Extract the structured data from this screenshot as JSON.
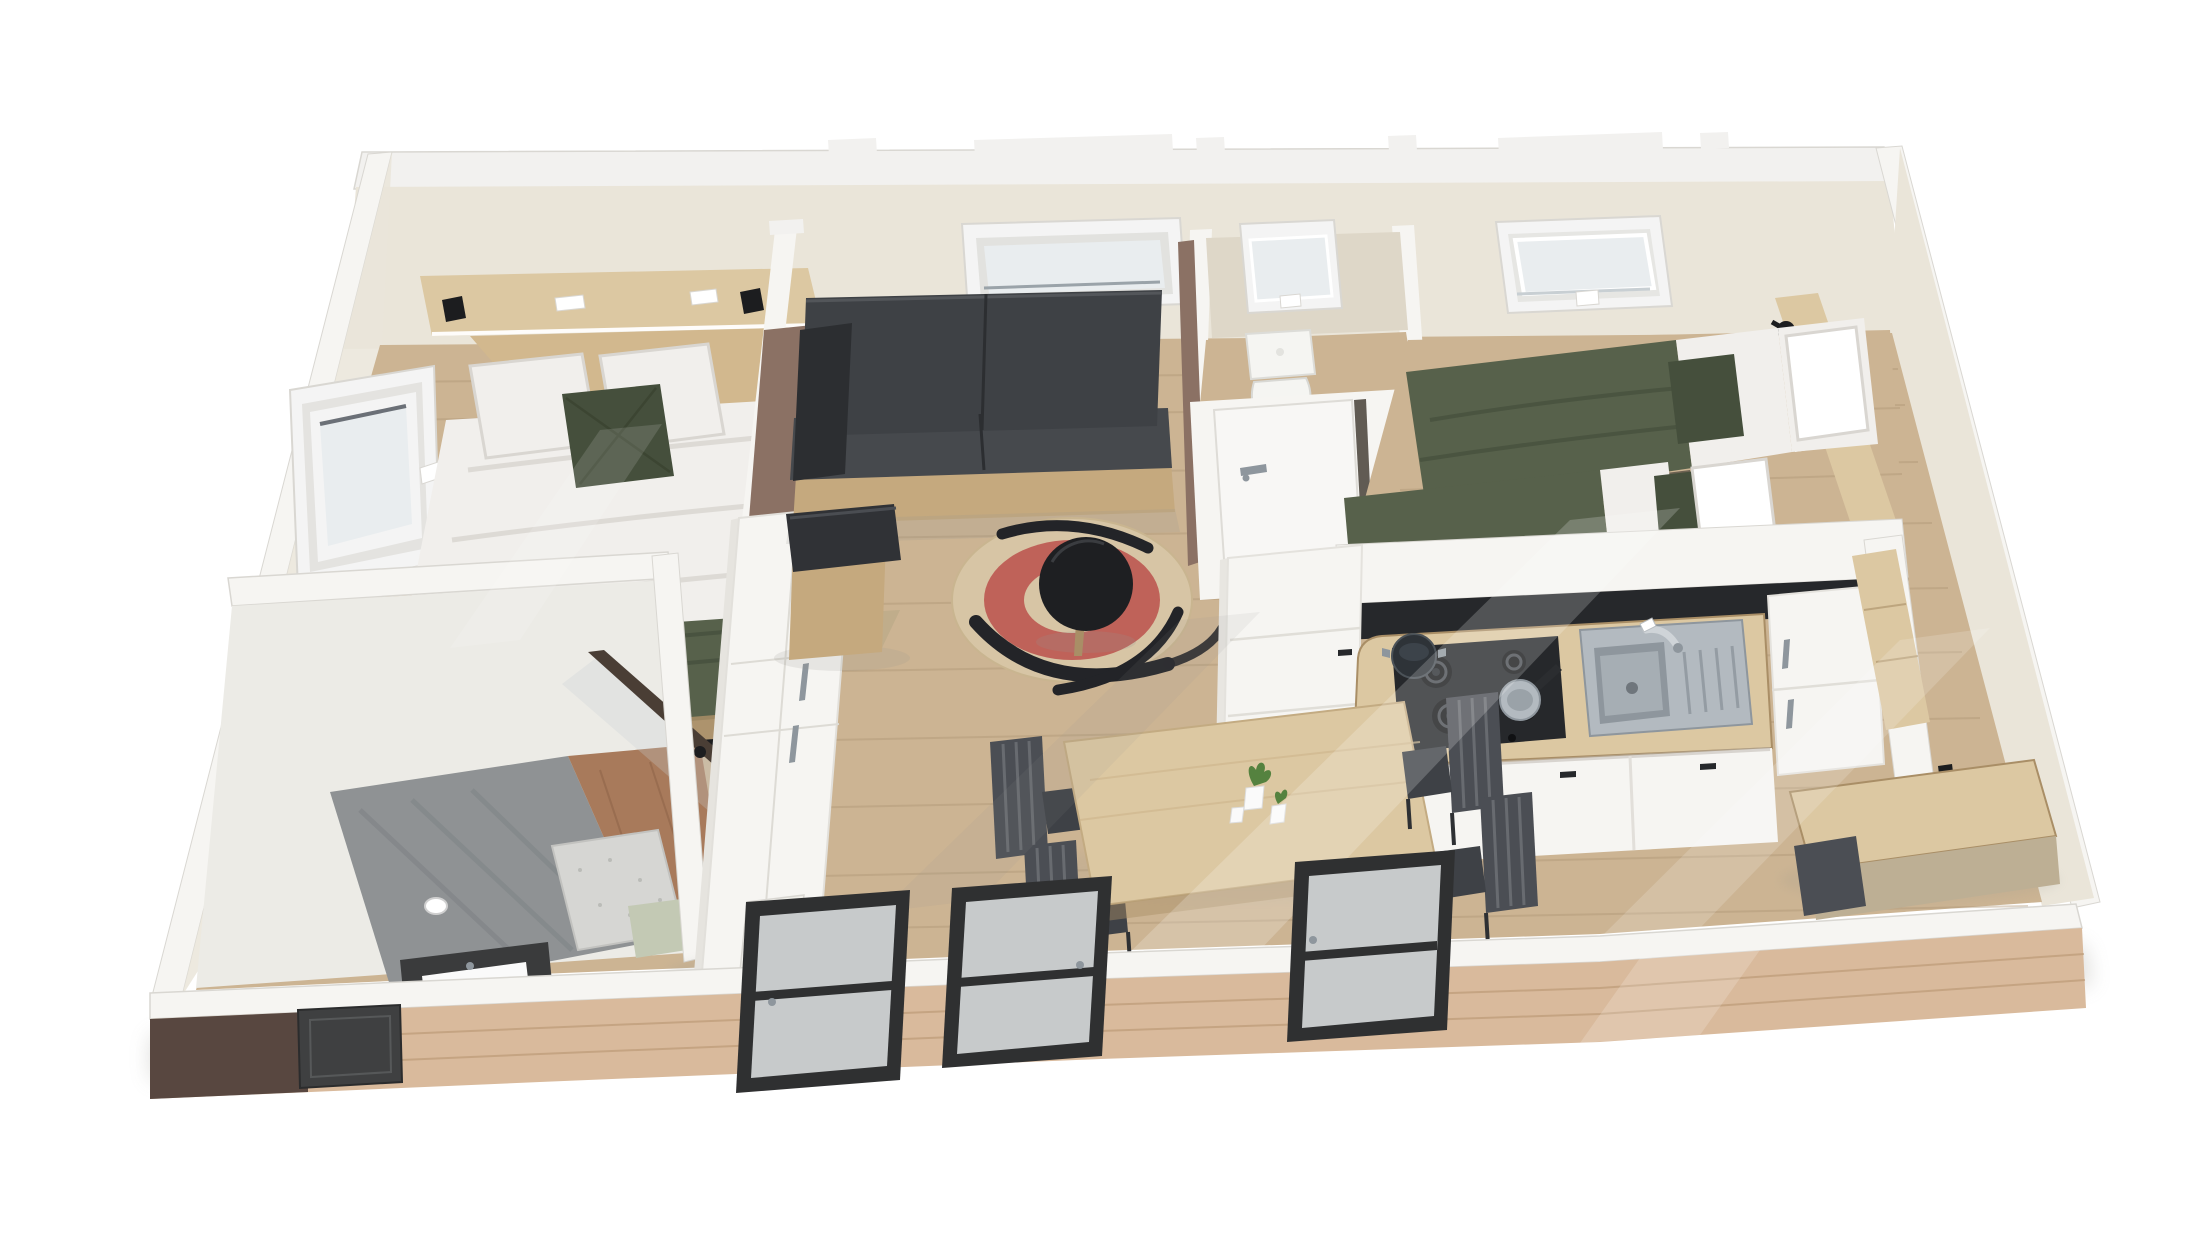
{
  "meta": {
    "title": "3D cutaway floor-plan render of a two-bedroom mobile home, bird's-eye isometric view on a white background",
    "view": "isometric bird's-eye cutaway",
    "background": "plain white"
  },
  "colors": {
    "wall_top": "#f2f1ef",
    "wall_edge": "#d9d7d2",
    "wall_white": "#f6f5f2",
    "wall_face": "#eae5d9",
    "wall_face_shade": "#ded7c8",
    "wall_brown": "#8b7164",
    "floor_wood": "#ccb493",
    "floor_plank": "#ad9374",
    "cladding": "#d9ba9c",
    "cladding_line": "#b5916e",
    "cladding_dark": "#584740",
    "window_frame": "#f4f4f4",
    "window_glass": "#e9edef",
    "glass_shade": "#c8cfd3",
    "sofa": "#3e4145",
    "sofa_dark": "#2c2e31",
    "wood_light": "#dcc8a2",
    "wood_mid": "#c5a97e",
    "wood_dark": "#a98e66",
    "duvet": "#f1efec",
    "duvet_shade": "#d9d6d1",
    "green_textile": "#57614b",
    "green_dark": "#454f3c",
    "rug_base": "#d7c5a5",
    "rug_red": "#bf6259",
    "rug_black": "#232428",
    "table_black": "#1e1f22",
    "chair": "#4b4e54",
    "chair_seat": "#3e4146",
    "steel": "#b3bac0",
    "steel_dark": "#8e969d",
    "appliance_black": "#26282b",
    "tile_terracotta": "#a87a5b",
    "shower_gray": "#8f9294",
    "shower_dark": "#72767a",
    "mat_gray": "#d6d6d3",
    "sage": "#c3c9b4",
    "black": "#1c1d1f",
    "door_dark": "#2f3031",
    "door_glass": "#d8dcdd",
    "toilet_white": "#f5f5f2",
    "pot_white": "#fafafa",
    "plant_green": "#55823f",
    "shadow_soft": "#98978f"
  },
  "rooms": [
    {
      "id": "bedroom-master",
      "label": "Master bedroom",
      "furniture": [
        "double bed with white duvet and olive throw",
        "two white pillows and olive accent cushion",
        "timber headboard panel and shelf with two black reading lamps",
        "tilt-open side window",
        "timber desk along front wall",
        "white bedside unit with curved timber shelves"
      ]
    },
    {
      "id": "bathroom",
      "label": "Shower room",
      "furniture": [
        "corner shower with concrete-look surround",
        "glass shower screen with dark trim",
        "terracotta tile floor",
        "grey bath mat",
        "vanity washbasin",
        "sage bench"
      ]
    },
    {
      "id": "hallway",
      "label": "Entry hall",
      "furniture": [
        "full-height white wardrobe with steel handles",
        "radiator grille",
        "taupe accent wall",
        "glazed entry door"
      ]
    },
    {
      "id": "living",
      "label": "Living / dining area",
      "furniture": [
        "charcoal sofa on timber base",
        "timber cube pouf with black cushion",
        "round jute rug with red ring and black motif",
        "black round side table",
        "timber dining table",
        "four dark dining chairs",
        "potted plants",
        "wide window above sofa"
      ]
    },
    {
      "id": "wc",
      "label": "Separate WC",
      "furniture": [
        "toilet",
        "small tilt window",
        "white door with lever handle"
      ]
    },
    {
      "id": "bedroom-twin",
      "label": "Twin bedroom",
      "furniture": [
        "two single beds with olive duvets and white folds",
        "white and olive pillows",
        "tilt-open roof window",
        "timber wall shelf with black spotlight",
        "tall timber wardrobe panel"
      ]
    },
    {
      "id": "kitchen",
      "label": "Kitchen",
      "furniture": [
        "four-burner gas hob with pot and pan",
        "stainless sink with drainer and mixer tap",
        "timber worktop",
        "black backsplash strip",
        "white base cabinets with dark handles",
        "two tall white appliance cabinets",
        "wall socket"
      ]
    },
    {
      "id": "rear-corner",
      "label": "Rear corner nook",
      "furniture": [
        "timber desk / sideboard",
        "dark stool",
        "timber wall shelf",
        "two black wall hooks"
      ]
    }
  ],
  "exterior": {
    "cladding": "light timber plank cladding",
    "openings": [
      "glazed entry door",
      "two dark-framed sliding glass doors",
      "small dark bathroom window"
    ]
  }
}
